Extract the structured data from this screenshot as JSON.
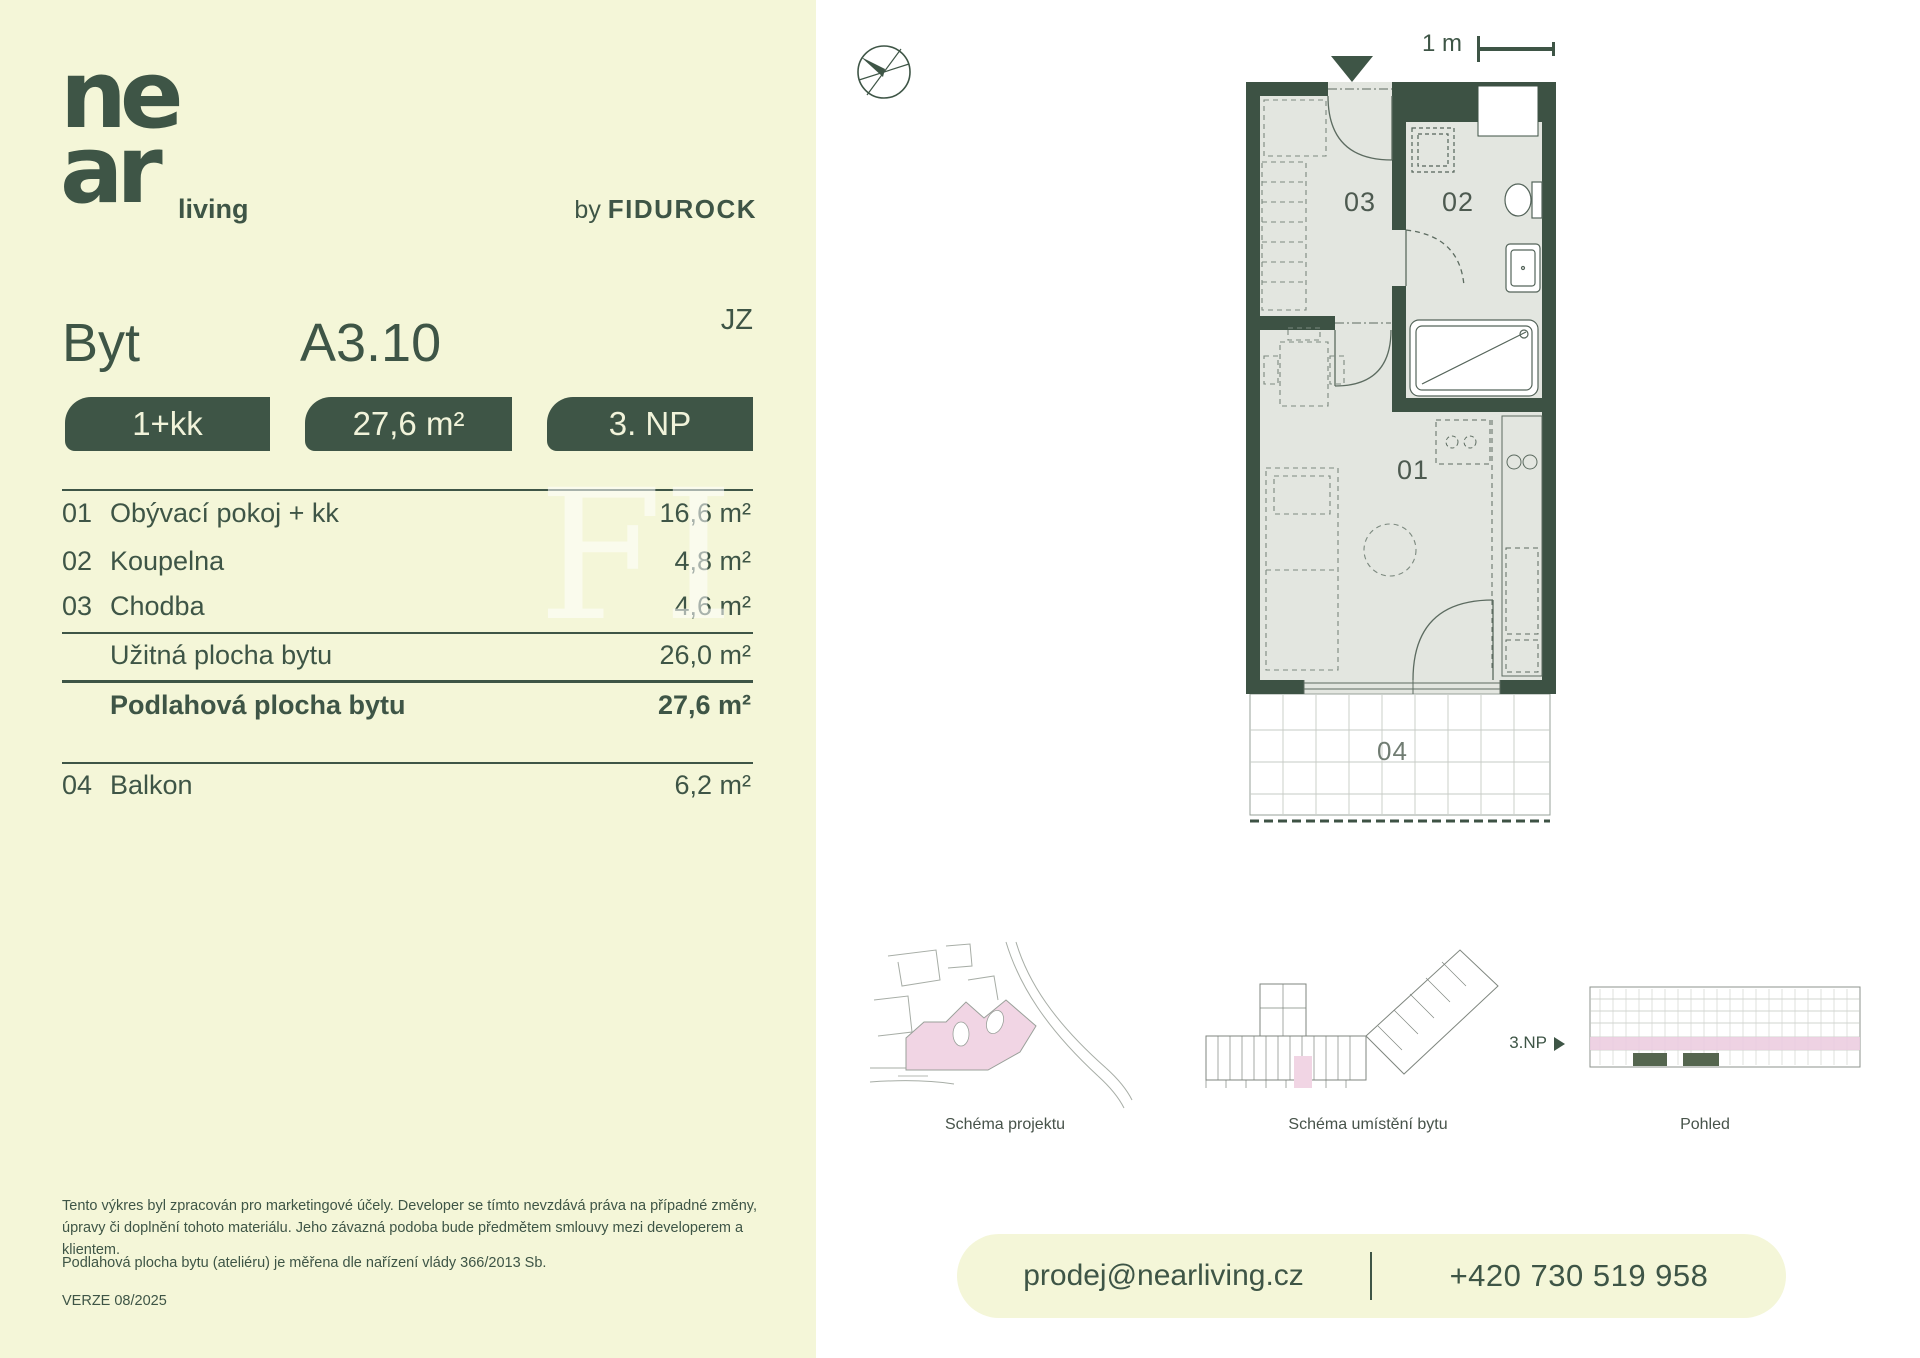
{
  "colors": {
    "cream": "#f4f6d8",
    "accent_green": "#3e5546",
    "wall_green": "#3d5244",
    "floor_gray": "#e3e6e0",
    "highlight_pink": "#f1d5e4"
  },
  "brand": {
    "logo_top": "ne",
    "logo_bottom": "ar",
    "logo_tagline": "living",
    "byline_prefix": "by",
    "byline_name": "FIDUROCK"
  },
  "header": {
    "unit_type_label": "Byt",
    "unit_id": "A3.10",
    "orientation": "JZ"
  },
  "badges": {
    "layout": "1+kk",
    "area": "27,6 m²",
    "floor": "3. NP"
  },
  "room_table": {
    "rows": [
      {
        "code": "01",
        "name": "Obývací pokoj + kk",
        "area": "16,6 m²"
      },
      {
        "code": "02",
        "name": "Koupelna",
        "area": "4,8 m²"
      },
      {
        "code": "03",
        "name": "Chodba",
        "area": "4,6 m²"
      }
    ],
    "usable": {
      "name": "Užitná plocha bytu",
      "area": "26,0 m²"
    },
    "total": {
      "name": "Podlahová plocha bytu",
      "area": "27,6 m²"
    },
    "extra": {
      "code": "04",
      "name": "Balkon",
      "area": "6,2 m²"
    }
  },
  "floorplan": {
    "scale_label": "1 m",
    "labels": {
      "l01": "01",
      "l02": "02",
      "l03": "03",
      "l04": "04"
    }
  },
  "schemes": {
    "project_caption": "Schéma projektu",
    "location_caption": "Schéma umístění bytu",
    "elevation_caption": "Pohled",
    "floor_marker": "3.NP"
  },
  "disclaimer": {
    "p1": "Tento výkres byl zpracován pro marketingové účely. Developer se tímto nevzdává práva na případné změny, úpravy či doplnění tohoto materiálu. Jeho závazná podoba bude předmětem smlouvy mezi developerem a klientem.",
    "p2": "Podlahová plocha bytu (ateliéru) je měřena dle nařízení vlády 366/2013 Sb.",
    "version": "VERZE 08/2025"
  },
  "contact": {
    "email": "prodej@nearliving.cz",
    "phone": "+420 730 519 958"
  },
  "watermark": "FI"
}
